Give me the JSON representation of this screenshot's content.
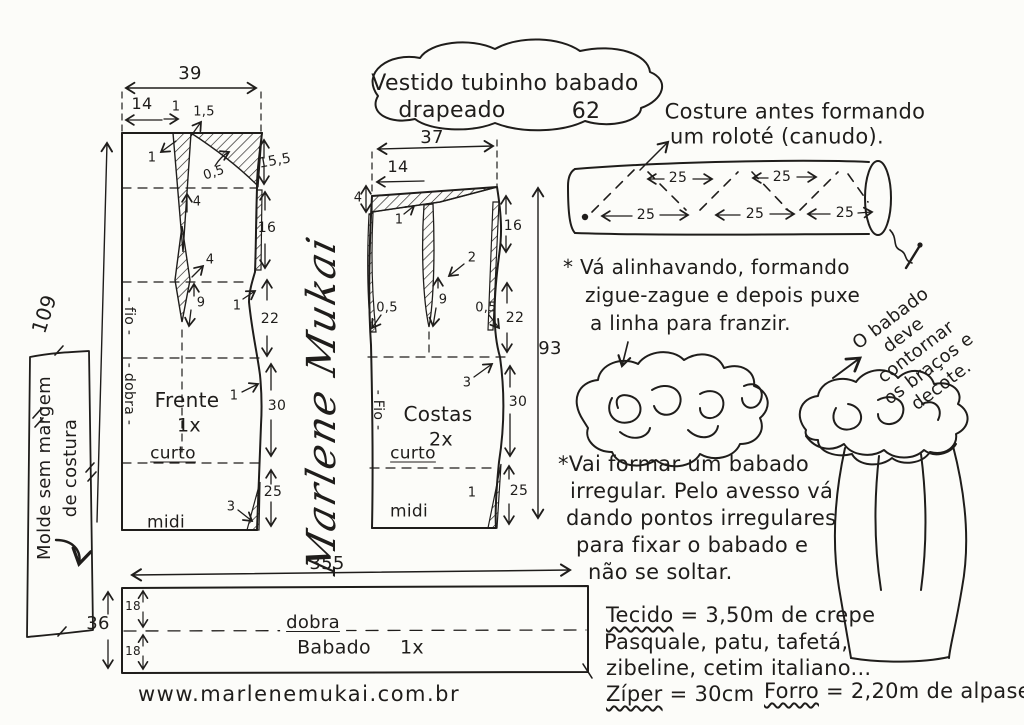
{
  "title": {
    "line1": "Vestido tubinho babado",
    "line2": "drapeado",
    "number": "62"
  },
  "watermark": {
    "signature": "Marlene Mukai"
  },
  "molde_note": {
    "line1": "Molde sem margem",
    "line2": "de costura"
  },
  "frente": {
    "name": "Frente",
    "qty": "1x",
    "grain": "- fio -",
    "fold": "- dobra -",
    "total_height": "109",
    "width": "39",
    "neck_width": "14",
    "tick": "1",
    "shoulder_drop": "1,5",
    "dart_note": "1",
    "ease": "0,5",
    "seg_155": "15,5",
    "seg_16": "16",
    "seg_22": "22",
    "seg_30": "30",
    "seg_25": "25",
    "dart_gap": "4",
    "dart_width": "4",
    "dart_length": "9",
    "waist_note": "1",
    "hip_note": "1",
    "hem_note": "3",
    "curto": "curto",
    "midi": "midi"
  },
  "costas": {
    "name": "Costas",
    "qty": "2x",
    "grain": "- Fio -",
    "total_height": "93",
    "width": "37",
    "neck_width": "14",
    "shoulder_seam": "4",
    "shoulder_note": "1",
    "seg_16": "16",
    "seg_22": "22",
    "seg_30": "30",
    "seg_25": "25",
    "dart_width": "2",
    "dart_length": "9",
    "ease_left": "0,5",
    "ease_right": "0,5",
    "hip_note": "3",
    "hem_note": "1",
    "curto": "curto",
    "midi": "midi"
  },
  "rolote": {
    "caption1": "Costure antes formando",
    "caption2": "um roloté (canudo).",
    "seg": "25"
  },
  "note1": {
    "line1": "* Vá alinhavando, formando",
    "line2": "zigue-zague e depois puxe",
    "line3": "a linha para franzir."
  },
  "babado_note": {
    "line1": "O babado",
    "line2": "deve contornar",
    "line3": "os braços e",
    "line4": "decote."
  },
  "note2": {
    "line1": "*Vai formar um babado",
    "line2": "irregular. Pelo avesso vá",
    "line3": "dando pontos irregulares",
    "line4": "para fixar o babado e",
    "line5": "não se soltar."
  },
  "materials": {
    "fabric_label": "Tecido",
    "fabric_value": "= 3,50m de crepe",
    "line2": "Pasquale, patu, tafetá,",
    "line3": "zibeline, cetim italiano...",
    "zipper_label": "Zíper",
    "zipper_value": "= 30cm",
    "lining_label": "Forro",
    "lining_value": "= 2,20m de alpaseda."
  },
  "babado_piece": {
    "name": "Babado",
    "qty": "1x",
    "width": "355",
    "height": "36",
    "half_top": "18",
    "half_bottom": "18",
    "fold": "dobra"
  },
  "website": "www.marlenemukai.com.br"
}
